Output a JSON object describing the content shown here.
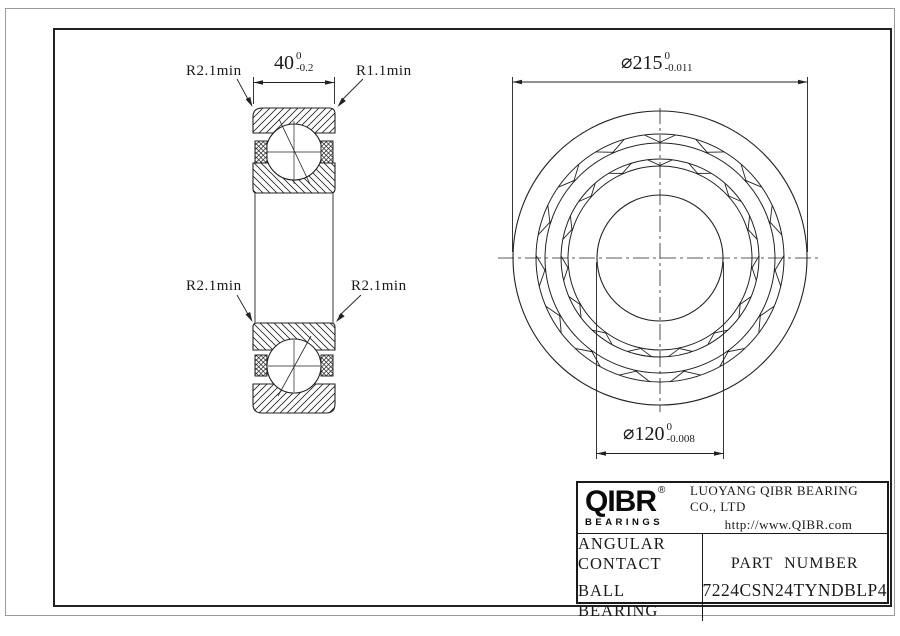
{
  "drawing": {
    "section_view": {
      "label_top_left": "R2.1min",
      "label_top_right": "R1.1min",
      "label_mid_left": "R2.1min",
      "label_mid_right": "R2.1min",
      "width_dim": {
        "value": "40",
        "tol_upper": "0",
        "tol_lower": "-0.2"
      }
    },
    "front_view": {
      "outer_dia": {
        "symbol": "⌀",
        "value": "215",
        "tol_upper": "0",
        "tol_lower": "-0.011"
      },
      "bore_dia": {
        "symbol": "⌀",
        "value": "120",
        "tol_upper": "0",
        "tol_lower": "-0.008"
      }
    }
  },
  "title_block": {
    "brand": "QIBR",
    "registered": "®",
    "brand_sub": "BEARINGS",
    "company": "LUOYANG QIBR BEARING CO., LTD",
    "website": "http://www.QIBR.com",
    "product_line1": "ANGULAR CONTACT",
    "product_line2": "BALL BEARING",
    "part_number_label": "PART NUMBER",
    "part_number": "7224CSN24TYNDBLP4"
  },
  "colors": {
    "line": "#1a1a1a",
    "background": "#ffffff"
  }
}
